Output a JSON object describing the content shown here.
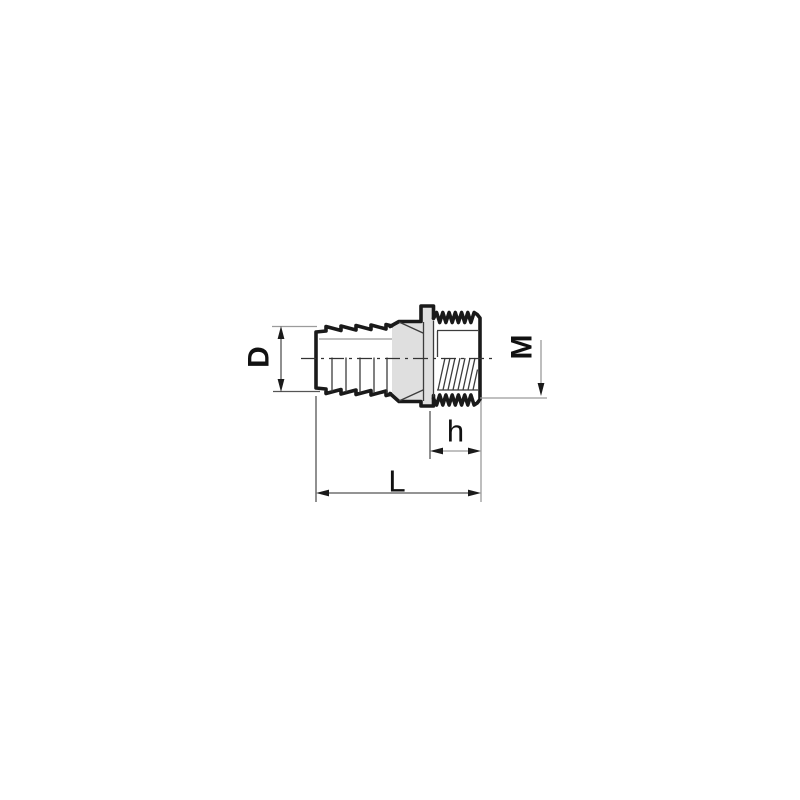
{
  "figure": {
    "dimension_labels": {
      "diameter": "D",
      "thread_size": "M",
      "thread_length": "h",
      "overall_length": "L"
    },
    "colors": {
      "line": "#1a1a1a",
      "thin_line": "#3c3c3c",
      "gray_line": "#9b9b9b",
      "collar_fill": "#dfdfdf",
      "background": "#ffffff"
    }
  }
}
